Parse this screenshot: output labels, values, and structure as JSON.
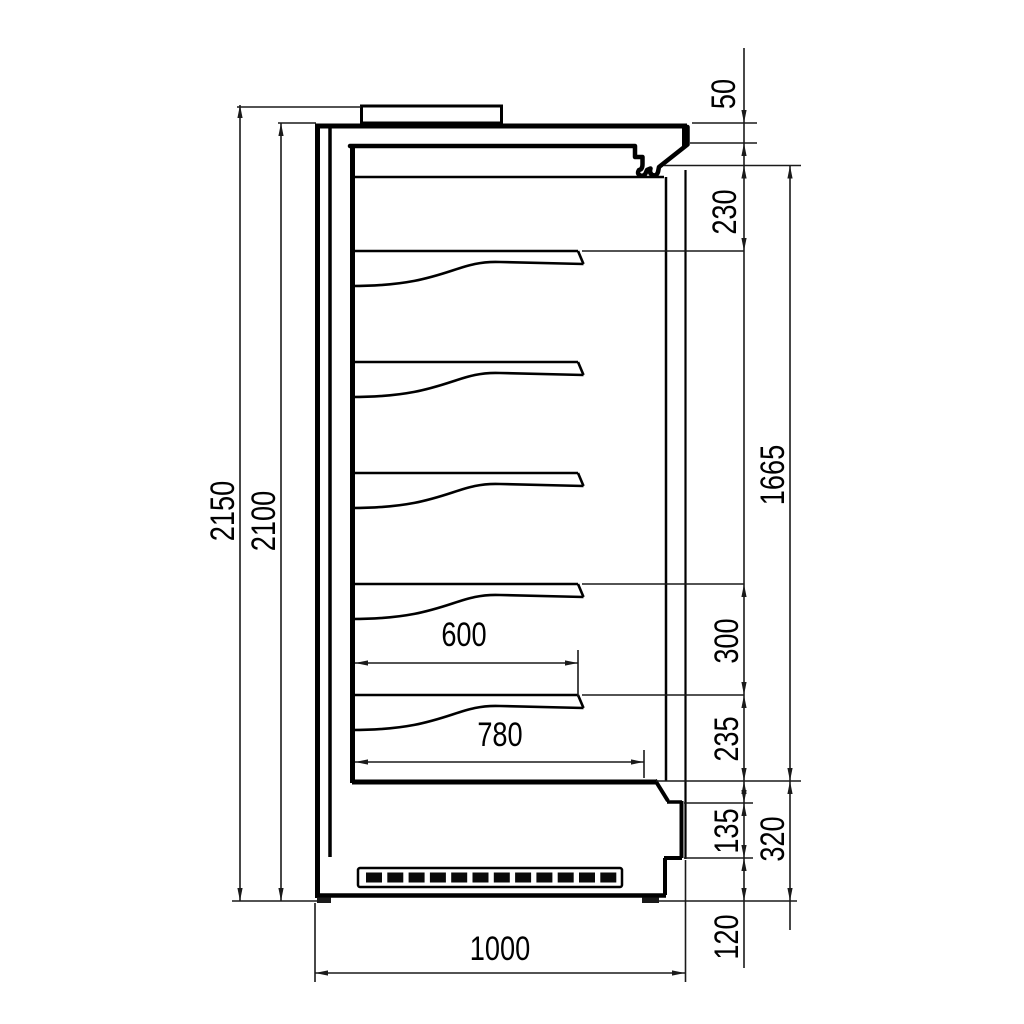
{
  "title": "Refrigerated multideck cabinet side-section drawing",
  "units": "mm",
  "dims": {
    "overall_height": "2150",
    "height_without_feet": "2100",
    "canopy_lip": "50",
    "canopy_to_top_shelf": "230",
    "interior_height": "1665",
    "shelf_spacing": "300",
    "bottom_shelf_to_deck": "235",
    "front_panel_height": "135",
    "base_height": "320",
    "plinth_height": "120",
    "shelf_depth": "600",
    "deck_depth": "780",
    "overall_depth": "1000"
  }
}
